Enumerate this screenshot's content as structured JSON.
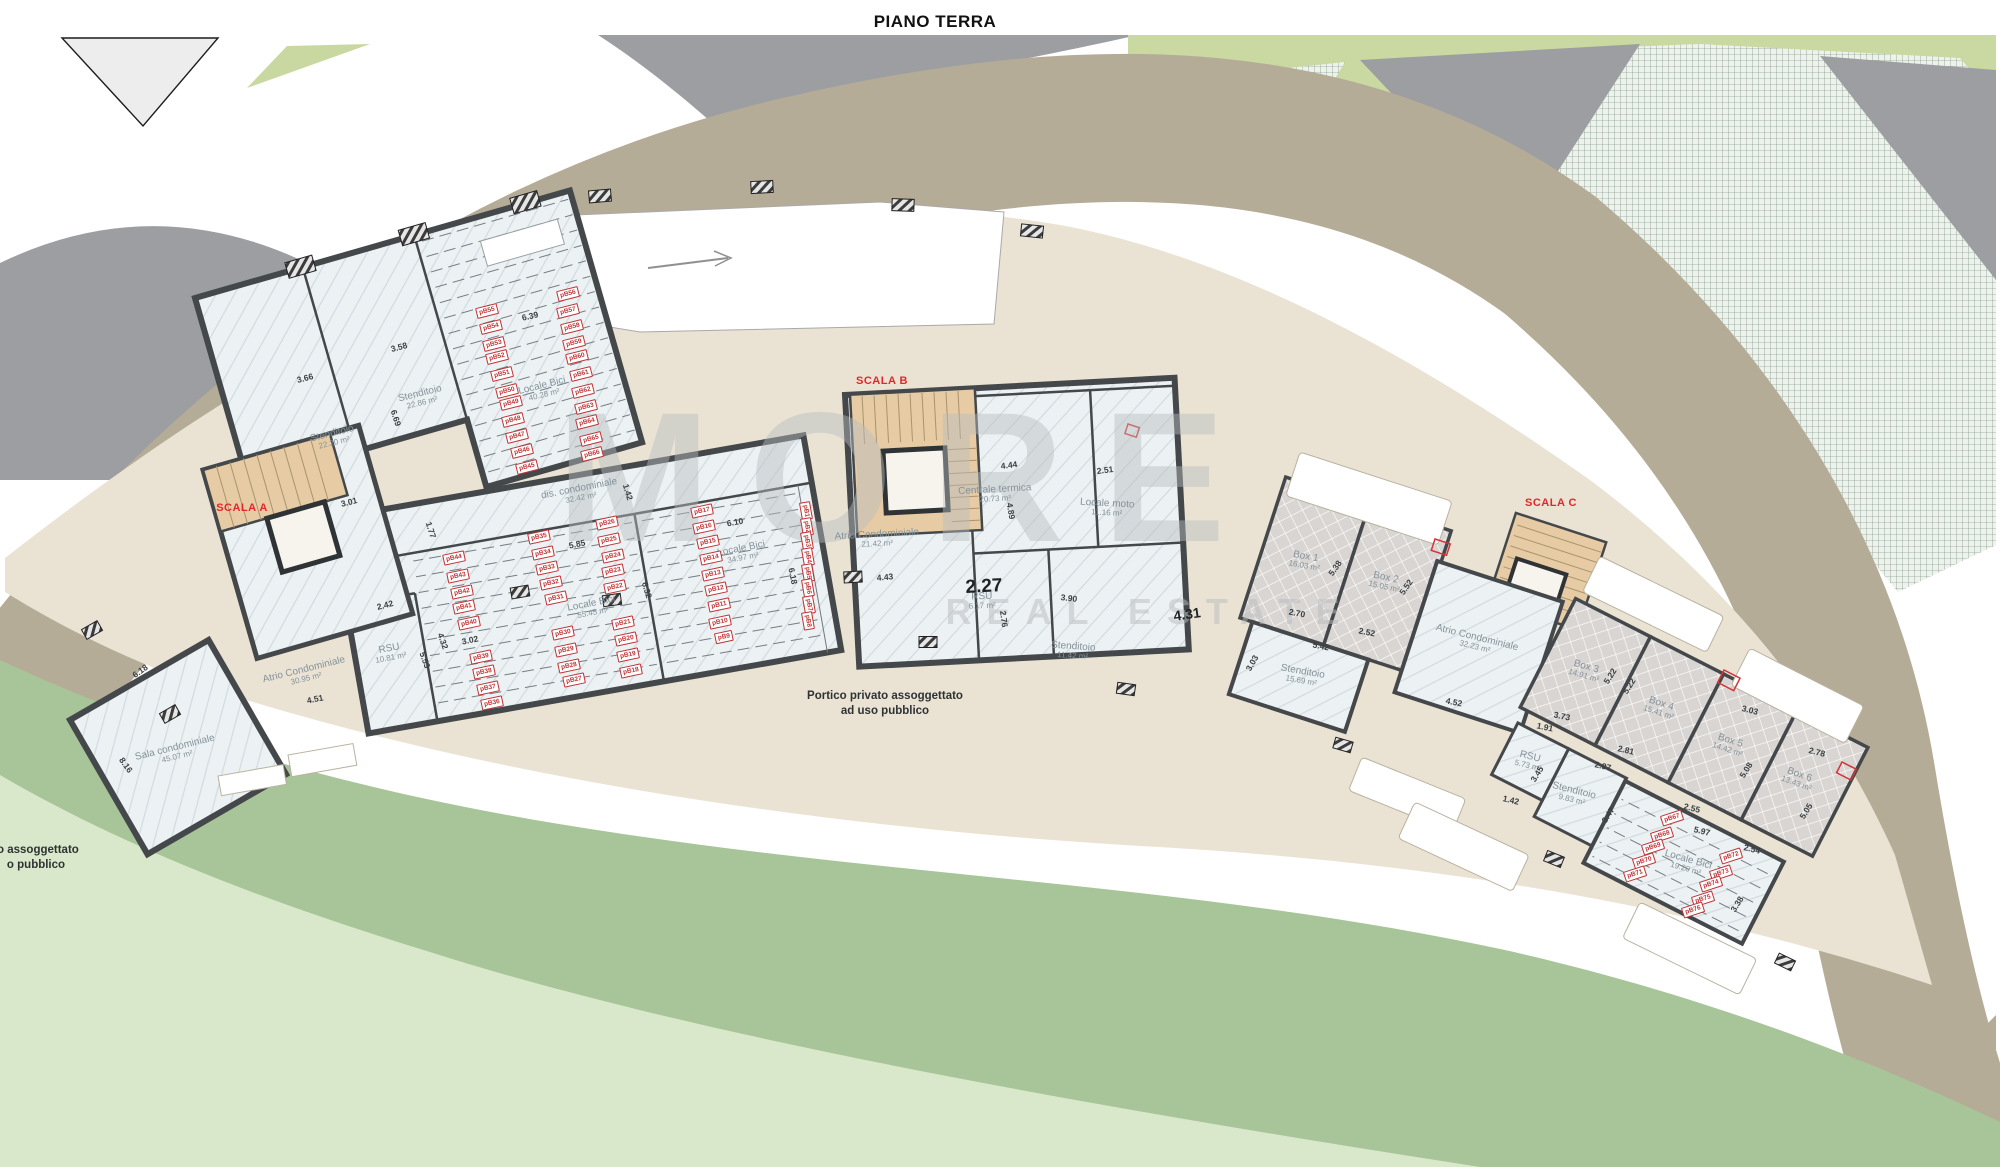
{
  "title": "PIANO TERRA",
  "watermark": {
    "line1": "MORE",
    "line2": "REAL ESTATE"
  },
  "colors": {
    "road_gray": "#9c9ea1",
    "road_tan": "#b5ac98",
    "plaza": "#eae3d4",
    "lawn_medium": "#a7c599",
    "lawn_light": "#d9e8ca",
    "green_band": "#cad8a2",
    "room_fill": "#ecf1f3",
    "wall": "#44484a",
    "stair_tan": "#e6cba4",
    "accent_red": "#e0282c",
    "parking_red": "#c03235"
  },
  "stairs": [
    {
      "label": "SCALA A",
      "x": 242,
      "y": 508,
      "r": 0
    },
    {
      "label": "SCALA B",
      "x": 882,
      "y": 381,
      "r": 0
    },
    {
      "label": "SCALA C",
      "x": 1551,
      "y": 503,
      "r": 0
    }
  ],
  "notes": [
    {
      "lines": [
        "Portico privato assoggettato",
        "ad uso pubblico"
      ],
      "x": 885,
      "y": 704,
      "r": 0
    },
    {
      "lines": [
        "to assoggettato",
        "o pubblico"
      ],
      "x": 36,
      "y": 858,
      "r": 0
    }
  ],
  "rooms": [
    {
      "n": "Stenditoio",
      "a": "22.20 m²",
      "x": 333,
      "y": 438,
      "r": -14
    },
    {
      "n": "Stenditoio",
      "a": "22.86 m²",
      "x": 421,
      "y": 398,
      "r": -14
    },
    {
      "n": "Locale Bici",
      "a": "40.28 m²",
      "x": 543,
      "y": 390,
      "r": -14
    },
    {
      "n": "dis. condominiale",
      "a": "32.42 m²",
      "x": 580,
      "y": 493,
      "r": -11
    },
    {
      "n": "Locale Bici",
      "a": "55.45 m²",
      "x": 592,
      "y": 608,
      "r": -11
    },
    {
      "n": "RSU",
      "a": "10.81 m²",
      "x": 390,
      "y": 653,
      "r": -11
    },
    {
      "n": "Locale Bici",
      "a": "34.97 m²",
      "x": 742,
      "y": 553,
      "r": -11
    },
    {
      "n": "Atrio Condominiale",
      "a": "30.95 m²",
      "x": 305,
      "y": 674,
      "r": -14
    },
    {
      "n": "Sala condominiale",
      "a": "45.07 m²",
      "x": 176,
      "y": 752,
      "r": -14
    },
    {
      "n": "Atrio Condominiale",
      "a": "21.42 m²",
      "x": 877,
      "y": 539,
      "r": -3
    },
    {
      "n": "Centrale termica",
      "a": "20.73 m²",
      "x": 995,
      "y": 494,
      "r": -3
    },
    {
      "n": "Locale moto",
      "a": "11.16 m²",
      "x": 1107,
      "y": 508,
      "r": 3
    },
    {
      "n": "RSU",
      "a": "6.17 m²",
      "x": 982,
      "y": 601,
      "r": -2
    },
    {
      "n": "Stenditoio",
      "a": "11.42 m²",
      "x": 1073,
      "y": 651,
      "r": 4
    },
    {
      "n": "Box 1",
      "a": "16.03 m²",
      "x": 1305,
      "y": 561,
      "r": 10
    },
    {
      "n": "Box 2",
      "a": "15.05 m²",
      "x": 1385,
      "y": 582,
      "r": 12
    },
    {
      "n": "Atrio Condominiale",
      "a": "32.23 m²",
      "x": 1476,
      "y": 642,
      "r": 14
    },
    {
      "n": "Stenditoio",
      "a": "15.69 m²",
      "x": 1302,
      "y": 676,
      "r": 10
    },
    {
      "n": "Box 3",
      "a": "14.91 m²",
      "x": 1585,
      "y": 671,
      "r": 16
    },
    {
      "n": "Box 4",
      "a": "15.41 m²",
      "x": 1660,
      "y": 708,
      "r": 18
    },
    {
      "n": "Box 5",
      "a": "14.42 m²",
      "x": 1729,
      "y": 745,
      "r": 18
    },
    {
      "n": "Box 6",
      "a": "13.43 m²",
      "x": 1798,
      "y": 779,
      "r": 20
    },
    {
      "n": "RSU",
      "a": "5.73 m²",
      "x": 1529,
      "y": 761,
      "r": 14
    },
    {
      "n": "Stenditoio",
      "a": "9.83 m²",
      "x": 1573,
      "y": 795,
      "r": 14
    },
    {
      "n": "Locale Bici",
      "a": "19.20 m²",
      "x": 1687,
      "y": 864,
      "r": 16
    }
  ],
  "dimensions": [
    {
      "t": "3.66",
      "x": 305,
      "y": 378,
      "r": -15
    },
    {
      "t": "3.58",
      "x": 399,
      "y": 347,
      "r": -15
    },
    {
      "t": "6.69",
      "x": 396,
      "y": 418,
      "r": 72
    },
    {
      "t": "6.39",
      "x": 530,
      "y": 316,
      "r": -13
    },
    {
      "t": "3.01",
      "x": 349,
      "y": 502,
      "r": -14
    },
    {
      "t": "1.77",
      "x": 431,
      "y": 530,
      "r": 72
    },
    {
      "t": "5.85",
      "x": 577,
      "y": 544,
      "r": -12
    },
    {
      "t": "1.42",
      "x": 628,
      "y": 492,
      "r": 73
    },
    {
      "t": "6.10",
      "x": 735,
      "y": 522,
      "r": -10
    },
    {
      "t": "6.18",
      "x": 793,
      "y": 576,
      "r": 78
    },
    {
      "t": "4.43",
      "x": 885,
      "y": 577,
      "r": -5
    },
    {
      "t": "3.02",
      "x": 470,
      "y": 640,
      "r": -12
    },
    {
      "t": "4.32",
      "x": 443,
      "y": 641,
      "r": 70
    },
    {
      "t": "5.53",
      "x": 425,
      "y": 660,
      "r": 70
    },
    {
      "t": "6.32",
      "x": 647,
      "y": 590,
      "r": 73
    },
    {
      "t": "6.18",
      "x": 140,
      "y": 671,
      "r": -35
    },
    {
      "t": "8.16",
      "x": 126,
      "y": 765,
      "r": 55
    },
    {
      "t": "4.51",
      "x": 315,
      "y": 699,
      "r": -12
    },
    {
      "t": "2.42",
      "x": 385,
      "y": 605,
      "r": -15
    },
    {
      "t": "4.44",
      "x": 1009,
      "y": 465,
      "r": -7
    },
    {
      "t": "2.51",
      "x": 1105,
      "y": 470,
      "r": -7
    },
    {
      "t": "4.89",
      "x": 1011,
      "y": 511,
      "r": 80
    },
    {
      "t": "3.90",
      "x": 1069,
      "y": 598,
      "r": 7
    },
    {
      "t": "2.76",
      "x": 1004,
      "y": 619,
      "r": 83
    },
    {
      "t": "2.27",
      "x": 984,
      "y": 587,
      "r": -3,
      "s": "big"
    },
    {
      "t": "4.31",
      "x": 1187,
      "y": 614,
      "r": -8,
      "s": "med"
    },
    {
      "t": "2.70",
      "x": 1297,
      "y": 613,
      "r": 10
    },
    {
      "t": "2.52",
      "x": 1367,
      "y": 632,
      "r": 11
    },
    {
      "t": "5.38",
      "x": 1335,
      "y": 568,
      "r": -55
    },
    {
      "t": "5.52",
      "x": 1406,
      "y": 587,
      "r": -55
    },
    {
      "t": "5.42",
      "x": 1321,
      "y": 646,
      "r": 11
    },
    {
      "t": "3.03",
      "x": 1252,
      "y": 663,
      "r": -60
    },
    {
      "t": "4.52",
      "x": 1454,
      "y": 702,
      "r": 12
    },
    {
      "t": "5.22",
      "x": 1610,
      "y": 676,
      "r": -58
    },
    {
      "t": "5.22",
      "x": 1629,
      "y": 686,
      "r": -58
    },
    {
      "t": "3.73",
      "x": 1562,
      "y": 716,
      "r": 12
    },
    {
      "t": "1.91",
      "x": 1545,
      "y": 727,
      "r": 12
    },
    {
      "t": "2.81",
      "x": 1626,
      "y": 750,
      "r": 13
    },
    {
      "t": "2.55",
      "x": 1692,
      "y": 808,
      "r": 14
    },
    {
      "t": "5.97",
      "x": 1702,
      "y": 831,
      "r": 14
    },
    {
      "t": "2.54",
      "x": 1752,
      "y": 849,
      "r": 14
    },
    {
      "t": "3.45",
      "x": 1537,
      "y": 774,
      "r": -58
    },
    {
      "t": "1.42",
      "x": 1511,
      "y": 800,
      "r": 13
    },
    {
      "t": "2.97",
      "x": 1603,
      "y": 766,
      "r": 13
    },
    {
      "t": "3.47",
      "x": 1608,
      "y": 815,
      "r": -58
    },
    {
      "t": "3.38",
      "x": 1737,
      "y": 904,
      "r": -58
    },
    {
      "t": "3.03",
      "x": 1750,
      "y": 710,
      "r": 14
    },
    {
      "t": "2.78",
      "x": 1817,
      "y": 752,
      "r": 14
    },
    {
      "t": "5.08",
      "x": 1746,
      "y": 770,
      "r": -58
    },
    {
      "t": "5.05",
      "x": 1806,
      "y": 811,
      "r": -58
    }
  ],
  "parking": [
    {
      "t": "pB55",
      "x": 487,
      "y": 311,
      "r": -14
    },
    {
      "t": "pB54",
      "x": 491,
      "y": 327,
      "r": -14
    },
    {
      "t": "pB53",
      "x": 494,
      "y": 344,
      "r": -14
    },
    {
      "t": "pB52",
      "x": 497,
      "y": 357,
      "r": -14
    },
    {
      "t": "pB51",
      "x": 502,
      "y": 374,
      "r": -14
    },
    {
      "t": "pB50",
      "x": 507,
      "y": 391,
      "r": -14
    },
    {
      "t": "pB49",
      "x": 511,
      "y": 403,
      "r": -14
    },
    {
      "t": "pB48",
      "x": 513,
      "y": 420,
      "r": -14
    },
    {
      "t": "pB47",
      "x": 517,
      "y": 436,
      "r": -14
    },
    {
      "t": "pB46",
      "x": 522,
      "y": 451,
      "r": -14
    },
    {
      "t": "pB45",
      "x": 527,
      "y": 467,
      "r": -14
    },
    {
      "t": "pB56",
      "x": 568,
      "y": 294,
      "r": -14
    },
    {
      "t": "pB57",
      "x": 568,
      "y": 311,
      "r": -14
    },
    {
      "t": "pB58",
      "x": 572,
      "y": 327,
      "r": -14
    },
    {
      "t": "pB59",
      "x": 574,
      "y": 343,
      "r": -14
    },
    {
      "t": "pB60",
      "x": 577,
      "y": 357,
      "r": -14
    },
    {
      "t": "pB61",
      "x": 581,
      "y": 374,
      "r": -14
    },
    {
      "t": "pB62",
      "x": 583,
      "y": 391,
      "r": -14
    },
    {
      "t": "pB63",
      "x": 586,
      "y": 407,
      "r": -14
    },
    {
      "t": "pB64",
      "x": 587,
      "y": 422,
      "r": -14
    },
    {
      "t": "pB65",
      "x": 591,
      "y": 439,
      "r": -14
    },
    {
      "t": "pB66",
      "x": 592,
      "y": 454,
      "r": -14
    },
    {
      "t": "pB44",
      "x": 454,
      "y": 558,
      "r": -12
    },
    {
      "t": "pB43",
      "x": 458,
      "y": 576,
      "r": -12
    },
    {
      "t": "pB42",
      "x": 462,
      "y": 592,
      "r": -12
    },
    {
      "t": "pB41",
      "x": 464,
      "y": 607,
      "r": -12
    },
    {
      "t": "pB40",
      "x": 469,
      "y": 623,
      "r": -12
    },
    {
      "t": "pB39",
      "x": 481,
      "y": 657,
      "r": -12
    },
    {
      "t": "pB38",
      "x": 484,
      "y": 672,
      "r": -12
    },
    {
      "t": "pB37",
      "x": 488,
      "y": 688,
      "r": -12
    },
    {
      "t": "pB36",
      "x": 492,
      "y": 703,
      "r": -12
    },
    {
      "t": "pB35",
      "x": 539,
      "y": 537,
      "r": -12
    },
    {
      "t": "pB34",
      "x": 543,
      "y": 553,
      "r": -12
    },
    {
      "t": "pB33",
      "x": 547,
      "y": 568,
      "r": -12
    },
    {
      "t": "pB32",
      "x": 551,
      "y": 583,
      "r": -12
    },
    {
      "t": "pB31",
      "x": 556,
      "y": 598,
      "r": -12
    },
    {
      "t": "pB30",
      "x": 563,
      "y": 633,
      "r": -12
    },
    {
      "t": "pB29",
      "x": 566,
      "y": 650,
      "r": -12
    },
    {
      "t": "pB28",
      "x": 569,
      "y": 666,
      "r": -12
    },
    {
      "t": "pB27",
      "x": 574,
      "y": 680,
      "r": -12
    },
    {
      "t": "pB26",
      "x": 607,
      "y": 523,
      "r": -12
    },
    {
      "t": "pB25",
      "x": 609,
      "y": 540,
      "r": -12
    },
    {
      "t": "pB24",
      "x": 613,
      "y": 556,
      "r": -12
    },
    {
      "t": "pB23",
      "x": 613,
      "y": 571,
      "r": -12
    },
    {
      "t": "pB22",
      "x": 615,
      "y": 587,
      "r": -12
    },
    {
      "t": "pB21",
      "x": 623,
      "y": 623,
      "r": -12
    },
    {
      "t": "pB20",
      "x": 626,
      "y": 639,
      "r": -12
    },
    {
      "t": "pB19",
      "x": 628,
      "y": 655,
      "r": -12
    },
    {
      "t": "pB18",
      "x": 631,
      "y": 671,
      "r": -12
    },
    {
      "t": "pB17",
      "x": 702,
      "y": 511,
      "r": -12
    },
    {
      "t": "pB16",
      "x": 704,
      "y": 527,
      "r": -12
    },
    {
      "t": "pB15",
      "x": 708,
      "y": 542,
      "r": -12
    },
    {
      "t": "pB14",
      "x": 711,
      "y": 558,
      "r": -12
    },
    {
      "t": "pB13",
      "x": 713,
      "y": 574,
      "r": -12
    },
    {
      "t": "pB12",
      "x": 716,
      "y": 589,
      "r": -12
    },
    {
      "t": "pB11",
      "x": 719,
      "y": 605,
      "r": -12
    },
    {
      "t": "pB10",
      "x": 720,
      "y": 622,
      "r": -12
    },
    {
      "t": "pB9",
      "x": 724,
      "y": 637,
      "r": -12
    },
    {
      "t": "pB1",
      "x": 806,
      "y": 511,
      "r": 80
    },
    {
      "t": "pB2",
      "x": 807,
      "y": 527,
      "r": 80
    },
    {
      "t": "pB3",
      "x": 807,
      "y": 541,
      "r": 80
    },
    {
      "t": "pB4",
      "x": 808,
      "y": 557,
      "r": 80
    },
    {
      "t": "pB5",
      "x": 808,
      "y": 573,
      "r": 80
    },
    {
      "t": "pB6",
      "x": 808,
      "y": 588,
      "r": 80
    },
    {
      "t": "pB7",
      "x": 809,
      "y": 605,
      "r": 80
    },
    {
      "t": "pB8",
      "x": 808,
      "y": 621,
      "r": 80
    },
    {
      "t": "pB67",
      "x": 1672,
      "y": 818,
      "r": -18
    },
    {
      "t": "pB68",
      "x": 1662,
      "y": 835,
      "r": -18
    },
    {
      "t": "pB69",
      "x": 1653,
      "y": 847,
      "r": -18
    },
    {
      "t": "pB70",
      "x": 1644,
      "y": 861,
      "r": -18
    },
    {
      "t": "pB71",
      "x": 1635,
      "y": 874,
      "r": -18
    },
    {
      "t": "pB72",
      "x": 1731,
      "y": 856,
      "r": -18
    },
    {
      "t": "pB73",
      "x": 1721,
      "y": 873,
      "r": -18
    },
    {
      "t": "pB74",
      "x": 1711,
      "y": 884,
      "r": -18
    },
    {
      "t": "pB75",
      "x": 1703,
      "y": 899,
      "r": -18
    },
    {
      "t": "pB76",
      "x": 1693,
      "y": 910,
      "r": -18
    }
  ]
}
